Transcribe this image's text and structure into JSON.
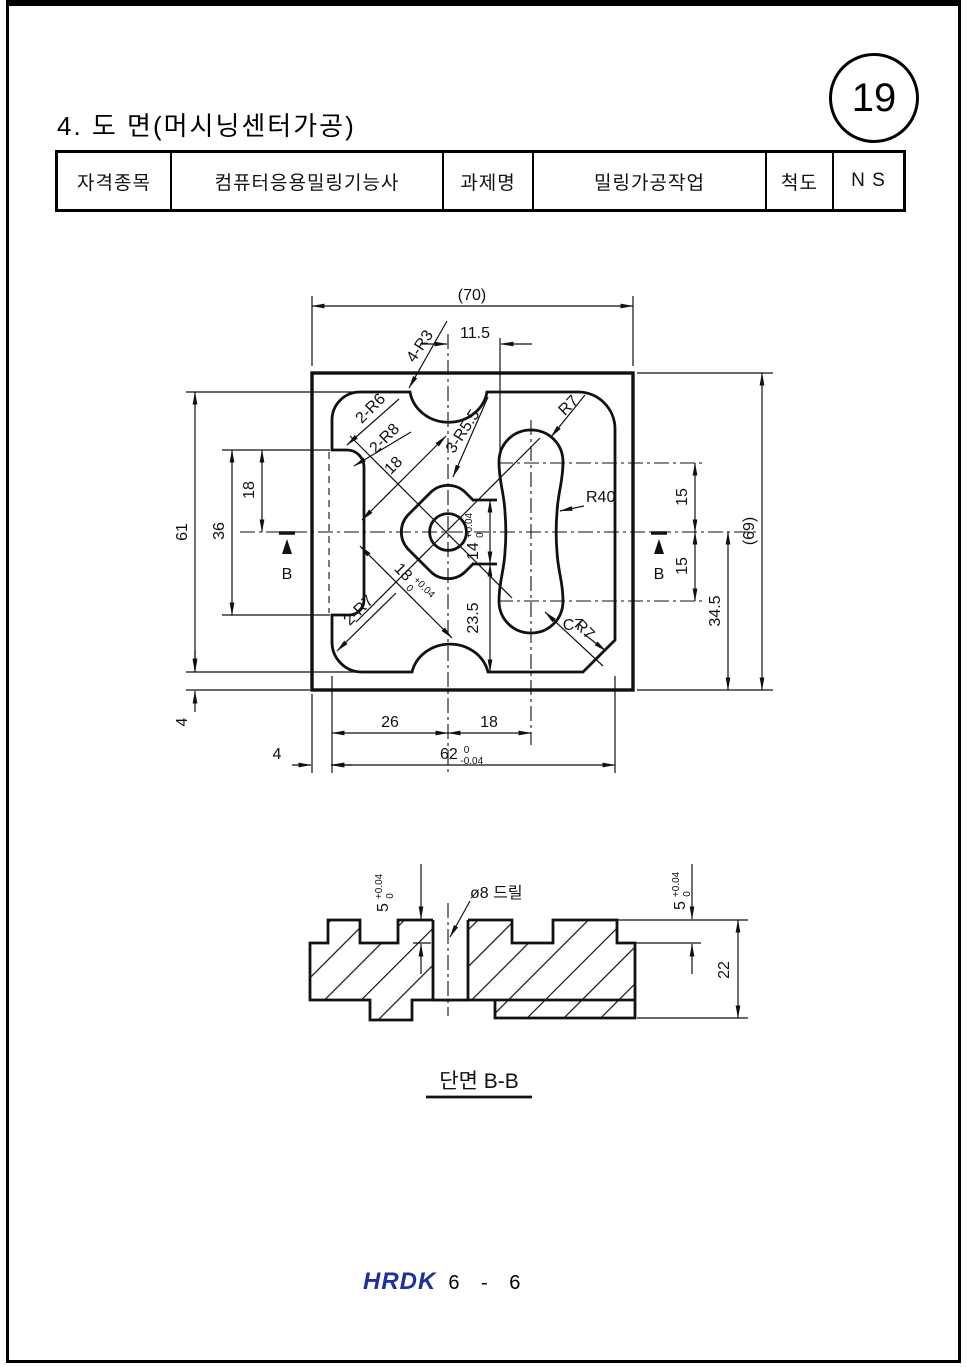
{
  "page": {
    "number": "19",
    "footer": {
      "logo": "HRDK",
      "page_info": "6 - 6"
    }
  },
  "header": {
    "title": "4. 도 면(머시닝센터가공)"
  },
  "info_table": {
    "cells": [
      {
        "label": "자격종목"
      },
      {
        "label": "컴퓨터응용밀링기능사"
      },
      {
        "label": "과제명"
      },
      {
        "label": "밀링가공작업"
      },
      {
        "label": "척도"
      },
      {
        "label": "N S"
      }
    ]
  },
  "main_view": {
    "width_ref": "(70)",
    "height_ref": "(69)",
    "d115": "11.5",
    "r3": "4-R3",
    "r6": "2-R6",
    "r8": "2-R8",
    "r55": "3-R5.5",
    "r7_top": "R7",
    "r40": "R40",
    "c7": "C7",
    "r7_bottom": "R7",
    "r7_pair": "2-R7",
    "d18_diag": "18",
    "d18_tol": {
      "v": "18",
      "top": "+0.04",
      "bot": "0"
    },
    "d14_tol": {
      "v": "14",
      "top": "+0.04",
      "bot": "0"
    },
    "d235": "23.5",
    "d61": "61",
    "d36": "36",
    "d18_left": "18",
    "d4_left": "4",
    "d15_upper": "15",
    "d15_lower": "15",
    "d345": "34.5",
    "d26": "26",
    "d18_bottom": "18",
    "d62_tol": {
      "v": "62",
      "top": "0",
      "bot": "-0.04"
    },
    "d4_bottom": "4",
    "section_mark_left": "B",
    "section_mark_right": "B"
  },
  "section_view": {
    "d5_left": {
      "v": "5",
      "top": "+0.04",
      "bot": "0"
    },
    "d5_right": {
      "v": "5",
      "top": "+0.04",
      "bot": "0"
    },
    "d22": "22",
    "drill_note": "ø8  드릴",
    "label": "단면 B-B"
  }
}
